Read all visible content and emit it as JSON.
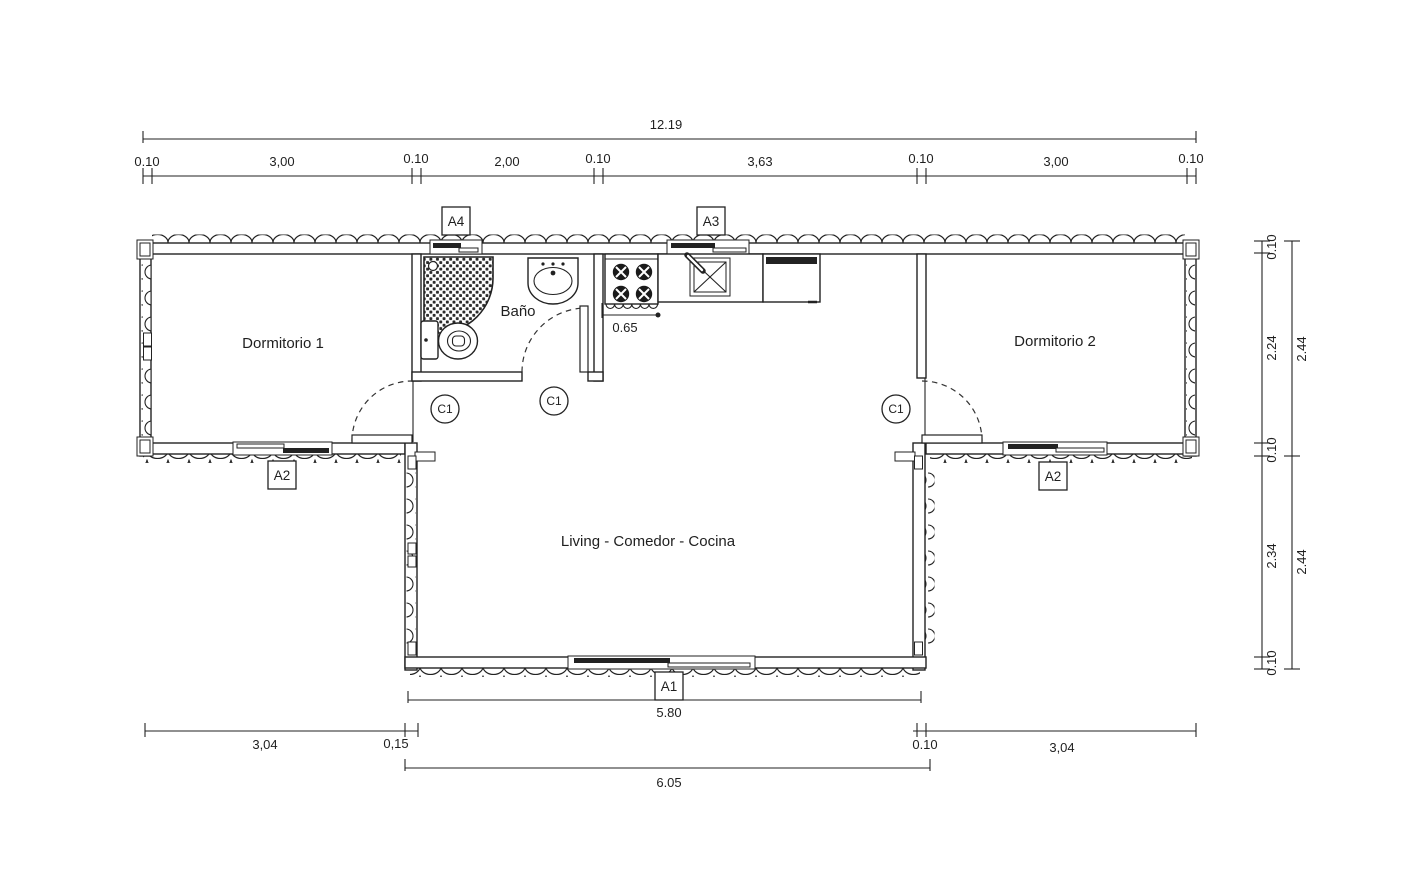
{
  "plan": {
    "rooms": {
      "dorm1": "Dormitorio 1",
      "bath": "Baño",
      "dorm2": "Dormitorio 2",
      "living": "Living - Comedor - Cocina"
    },
    "tags": {
      "a1": "A1",
      "a2": "A2",
      "a3": "A3",
      "a4": "A4",
      "c1": "C1"
    },
    "dims": {
      "top_total": "12.19",
      "top_segments": [
        "0.10",
        "3,00",
        "0.10",
        "2,00",
        "0.10",
        "3,63",
        "0.10",
        "3,00",
        "0.10"
      ],
      "stove": "0.65",
      "right_inner": [
        "0.10",
        "2.24",
        "0.10",
        "2.34",
        "0.10"
      ],
      "right_outer": [
        "2.44",
        "2.44"
      ],
      "bottom_living_inner": "5.80",
      "bottom_left": [
        "3,04",
        "0,15"
      ],
      "bottom_right": [
        "0.10",
        "3,04"
      ],
      "bottom_living_outer": "6.05"
    },
    "colors": {
      "line": "#222222",
      "text": "#1f1f1f"
    }
  }
}
